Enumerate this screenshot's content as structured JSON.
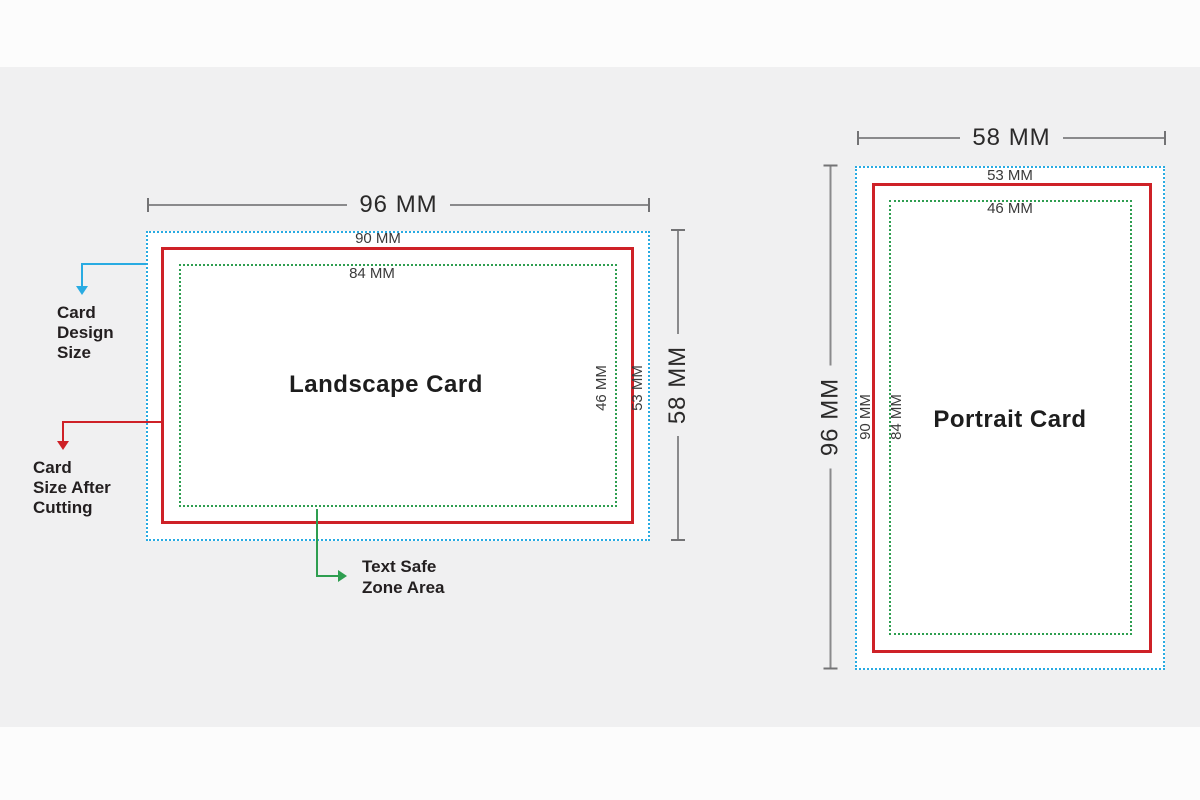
{
  "diagram": {
    "colors": {
      "design_size_border": "#29abe2",
      "cut_size_border": "#ce2127",
      "safe_zone_border": "#2e9e50",
      "dimension_line": "#8a8a8c",
      "background": "#f0f0f1",
      "card_fill": "#ffffff",
      "text": "#231f20"
    },
    "legend": {
      "design_size_label": "Card\nDesign\nSize",
      "cut_size_label": "Card\nSize After\nCutting",
      "safe_zone_label": "Text Safe\nZone Area"
    },
    "landscape": {
      "title": "Landscape Card",
      "total_width": "96 MM",
      "total_height": "58 MM",
      "cut_width": "90 MM",
      "safe_width": "84 MM",
      "safe_height": "46 MM",
      "cut_height": "53 MM"
    },
    "portrait": {
      "title": "Portrait Card",
      "total_width": "58 MM",
      "total_height": "96 MM",
      "cut_width": "53 MM",
      "safe_width": "46 MM",
      "cut_height": "90 MM",
      "safe_height": "84 MM"
    }
  }
}
